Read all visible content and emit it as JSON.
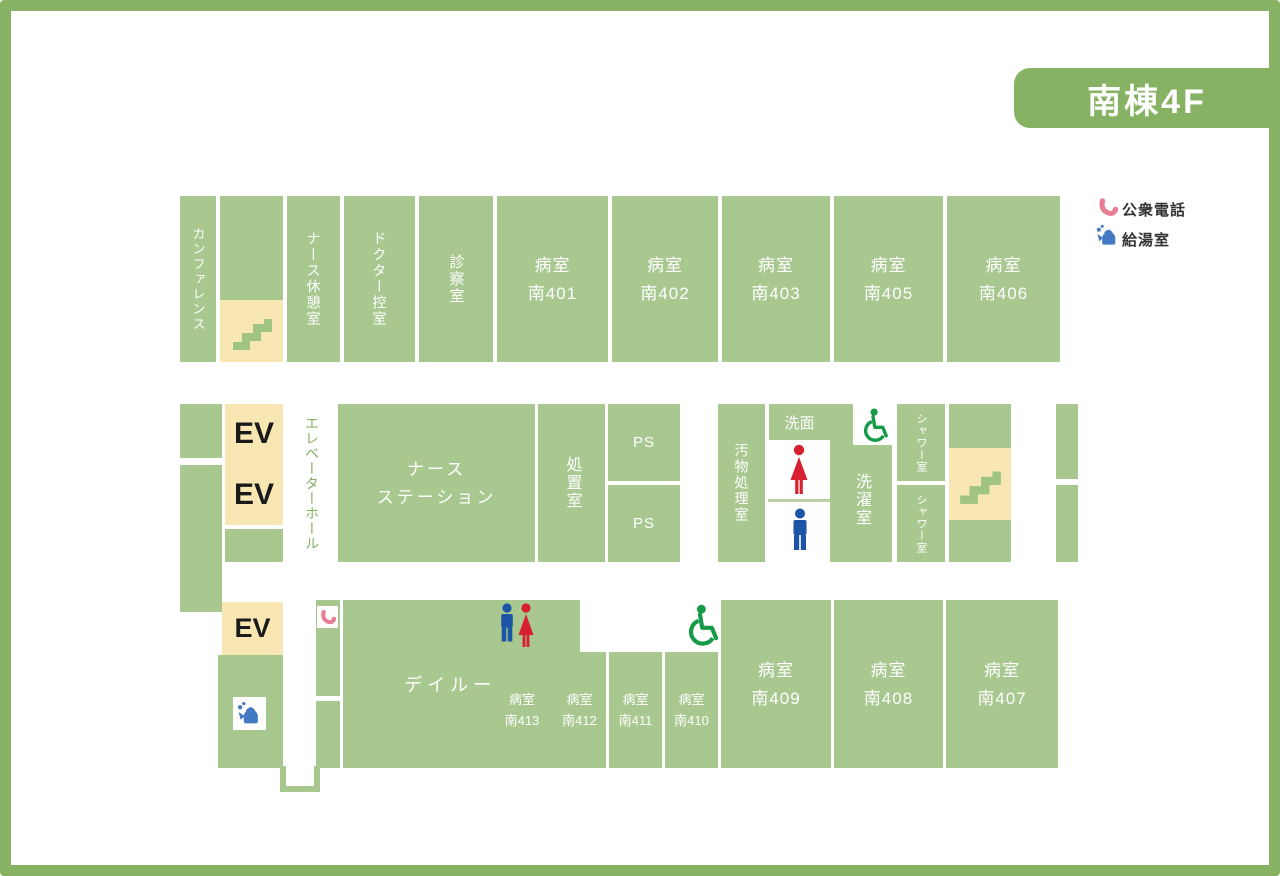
{
  "title": "南棟4F",
  "legend": {
    "phone_label": "公衆電話",
    "kettle_label": "給湯室"
  },
  "rooms": {
    "conference": "カンファレンス",
    "nurse_rest": "ナース休憩室",
    "doctor_lounge": "ドクター控室",
    "exam": "診察室",
    "ward": "病室",
    "elevator_hall": "エレベーターホール",
    "ev": "EV",
    "nurse_station_l1": "ナース",
    "nurse_station_l2": "ステーション",
    "treatment": "処置室",
    "ps": "PS",
    "waste": "汚物処理室",
    "washbasin": "洗面",
    "laundry": "洗濯室",
    "shower": "シャワー室",
    "dayroom": "デイルーム"
  },
  "ward_numbers": {
    "n401": "南401",
    "n402": "南402",
    "n403": "南403",
    "n405": "南405",
    "n406": "南406",
    "n407": "南407",
    "n408": "南408",
    "n409": "南409",
    "n410": "南410",
    "n411": "南411",
    "n412": "南412",
    "n413": "南413"
  },
  "icons": {
    "phone": "phone-handset-icon",
    "kettle": "kettle-icon",
    "female": "female-icon",
    "male": "male-icon",
    "wheelchair": "wheelchair-icon",
    "stairs": "stairs-icon"
  },
  "colors": {
    "room_green": "#a9c890",
    "accent_green": "#88b263",
    "cream": "#f8e7b3",
    "stair_green": "#9fc483",
    "phone_pink": "#e87e93",
    "kettle_blue": "#4479c4",
    "female_red": "#d6202f",
    "male_blue": "#1c55a5",
    "wheelchair_green": "#169a47"
  }
}
